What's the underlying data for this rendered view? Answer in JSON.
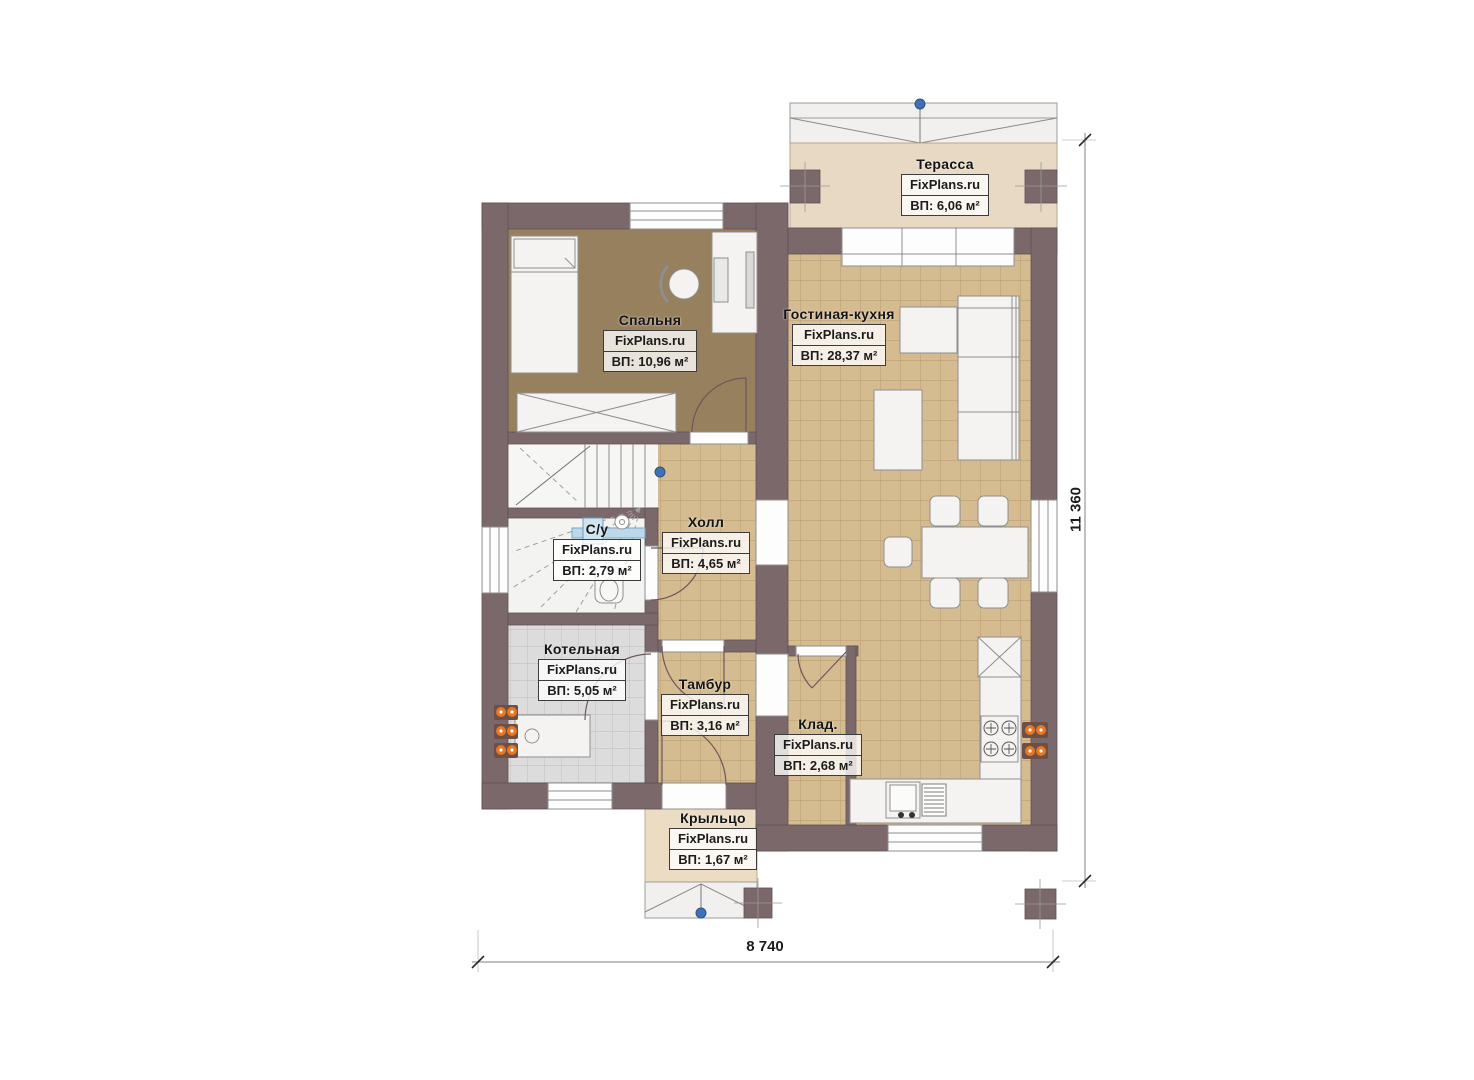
{
  "plan": {
    "brand": "FixPlans.ru",
    "rooms": [
      {
        "name": "Терасса",
        "area": "ВП: 6,06 м²"
      },
      {
        "name": "Спальня",
        "area": "ВП: 10,96 м²"
      },
      {
        "name": "Гостиная-кухня",
        "area": "ВП: 28,37 м²"
      },
      {
        "name": "С/у",
        "area": "ВП: 2,79 м²"
      },
      {
        "name": "Холл",
        "area": "ВП: 4,65 м²"
      },
      {
        "name": "Котельная",
        "area": "ВП: 5,05 м²"
      },
      {
        "name": "Тамбур",
        "area": "ВП: 3,16 м²"
      },
      {
        "name": "Клад.",
        "area": "ВП: 2,68 м²"
      },
      {
        "name": "Крыльцо",
        "area": "ВП: 1,67 м²"
      }
    ],
    "dimensions": {
      "width": "8 740",
      "height": "11 360"
    },
    "colors": {
      "wall": "#7b686a",
      "tile_floor": "#d5bb90",
      "bedroom_floor": "#97805e",
      "terrace_floor": "#e8d9c4",
      "boiler_floor": "#dcdcdc",
      "socket_accent": "#e87722",
      "survey_marker": "#3f72b5"
    }
  }
}
